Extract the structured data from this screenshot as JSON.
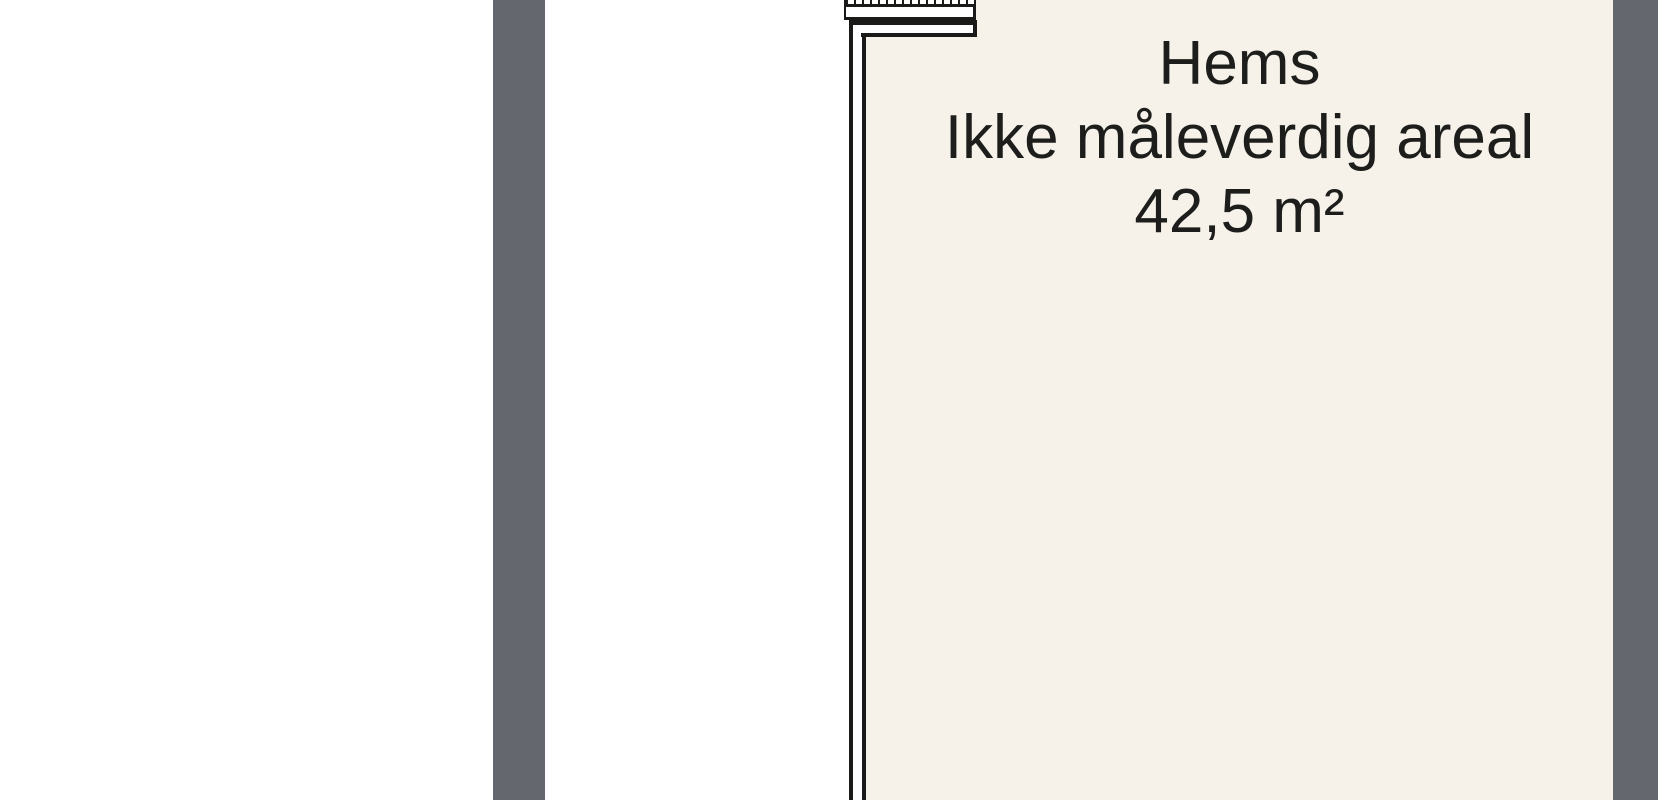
{
  "plan": {
    "room": {
      "name": "Hems",
      "note": "Ikke måleverdig areal",
      "area": "42,5 m²"
    }
  },
  "colors": {
    "background": "#ffffff",
    "room_fill": "#f6f2ea",
    "wall_fill_gray": "#64676d",
    "wall_line": "#1a1a19",
    "text": "#1d1d1b"
  }
}
